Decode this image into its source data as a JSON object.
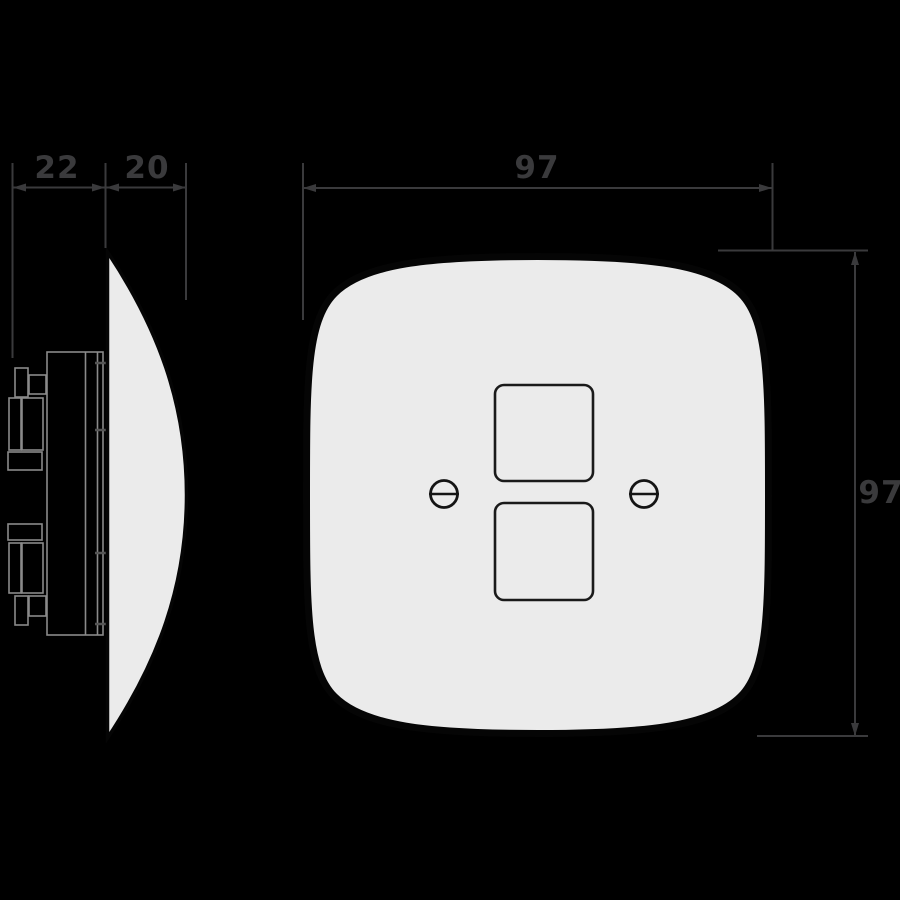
{
  "diagram": {
    "title": "Wall switch plate technical dimension drawing",
    "views": {
      "side_view": "plate side profile with mounting mechanism",
      "front_view": "rounded square plate with two switch openings and two screws"
    },
    "dimensions": {
      "mechanism_depth": {
        "value": "22",
        "unit_hint": "mm"
      },
      "plate_depth": {
        "value": "20",
        "unit_hint": "mm"
      },
      "plate_width": {
        "value": "97",
        "unit_hint": "mm"
      },
      "plate_height": {
        "value": "97",
        "unit_hint": "mm"
      }
    },
    "colors": {
      "background": "#000000",
      "dimension_lines": "#3a3a3c",
      "plate_fill": "#ebebeb",
      "plate_outline": "#050505",
      "mechanism_outline": "#8a8a8a",
      "detail_stroke": "#1a1a1a"
    }
  }
}
